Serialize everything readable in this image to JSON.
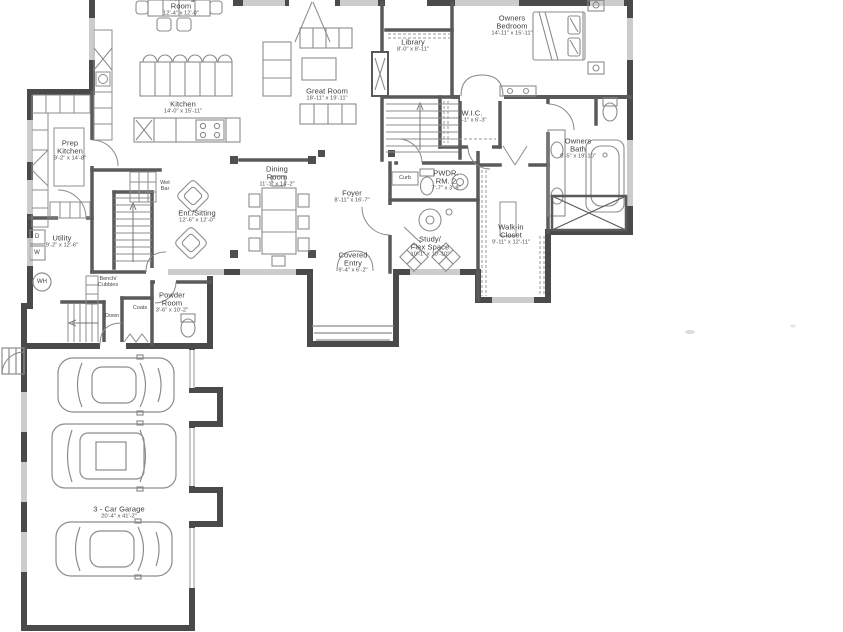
{
  "colors": {
    "walls": "#4a4a4a",
    "interior_walls": "#5a5a5a",
    "furniture_lines": "#8c8c8c",
    "text": "#3c3c3c",
    "background": "#ffffff"
  },
  "rooms": {
    "morning_room": {
      "name": "Morning",
      "name2": "Room",
      "dims": "12'-4\" x 12'-0\""
    },
    "kitchen": {
      "name": "Kitchen",
      "name2": "",
      "dims": "14'-0\" x 15'-11\""
    },
    "prep_kitchen": {
      "name": "Prep",
      "name2": "Kitchen",
      "dims": "9'-2\" x 14'-8\""
    },
    "great_room": {
      "name": "Great Room",
      "name2": "",
      "dims": "18'-11\" x 19'-11\""
    },
    "library": {
      "name": "Library",
      "name2": "",
      "dims": "8'-0\" x 8'-11\""
    },
    "owners_bedroom": {
      "name": "Owners",
      "name2": "Bedroom",
      "dims": "14'-11\" x 15'-11\""
    },
    "wic": {
      "name": "W.I.C.",
      "name2": "",
      "dims": "7'-1\" x 6'-3\""
    },
    "owners_bath": {
      "name": "Owners",
      "name2": "Bath",
      "dims": "8'-5\" x 19'-10\""
    },
    "pwdr_rm2": {
      "name": "PWDR.",
      "name2": "RM. 2",
      "dims": "7'-7\" x 3'-8\""
    },
    "walkin_closet": {
      "name": "Walk-in",
      "name2": "Closet",
      "dims": "9'-11\" x 12'-11\""
    },
    "study": {
      "name": "Study/",
      "name2": "Flex Space",
      "dims": "10'-1\" x 10'-10\""
    },
    "dining_room": {
      "name": "Dining",
      "name2": "Room",
      "dims": "11'-1\" x 14'-2\""
    },
    "foyer": {
      "name": "Foyer",
      "name2": "",
      "dims": "8'-11\" x 16'-7\""
    },
    "covered_entry": {
      "name": "Covered",
      "name2": "Entry",
      "dims": "9'-4\" x 6'-2\""
    },
    "ent_sitting": {
      "name": "Ent./Sitting",
      "name2": "",
      "dims": "12'-6\" x 12'-0\""
    },
    "utility": {
      "name": "Utility",
      "name2": "",
      "dims": "9'-2\" x 12'-6\""
    },
    "powder_room": {
      "name": "Powder",
      "name2": "Room",
      "dims": "3'-6\" x 10'-2\""
    },
    "garage": {
      "name": "3 - Car Garage",
      "name2": "",
      "dims": "20'-4\" x 41'-2\""
    }
  },
  "annotations": {
    "wet_bar": "Wet Bar",
    "bench_cubbies": "Bench/ Cubbies",
    "down": "Down",
    "coats": "Coats",
    "curb": "Curb",
    "wh": "WH",
    "dryer": "D",
    "washer": "W"
  }
}
